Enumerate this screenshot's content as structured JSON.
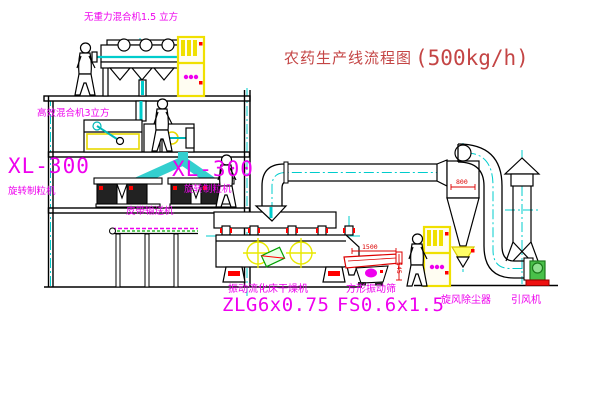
{
  "title": {
    "zh": "农药生产线流程图",
    "capacity": "(500kg/h)"
  },
  "labels": {
    "top_mixer": "无重力混合机1.5 立方",
    "mid_mixer": "高效混合机3立方",
    "granulator_left_model": "XL-300",
    "granulator_left_name": "旋转制粒机",
    "granulator_right_model": "XL-300",
    "granulator_right_name": "旋转制粒机",
    "belt_conveyor": "皮带输送机",
    "dryer_name": "振动流化床干燥机",
    "dryer_model": "ZLG6x0.75",
    "screen_name": "方形振动筛",
    "screen_model": "FS0.6x1.5",
    "cyclone": "旋风除尘器",
    "fan": "引风机"
  },
  "dimensions": {
    "screen_length": "1500",
    "screen_height": "545",
    "cyclone_width": "800"
  },
  "colors": {
    "label_magenta": "#ee00ee",
    "title_red": "#c44545",
    "dimension_red": "#dd0000",
    "centerline_cyan": "#00cccc",
    "cabinet_yellow": "#f0e000",
    "target_yellow": "#e8e800",
    "fan_green": "#49c049",
    "alert_red": "#ff0000",
    "line_black": "#000000"
  }
}
